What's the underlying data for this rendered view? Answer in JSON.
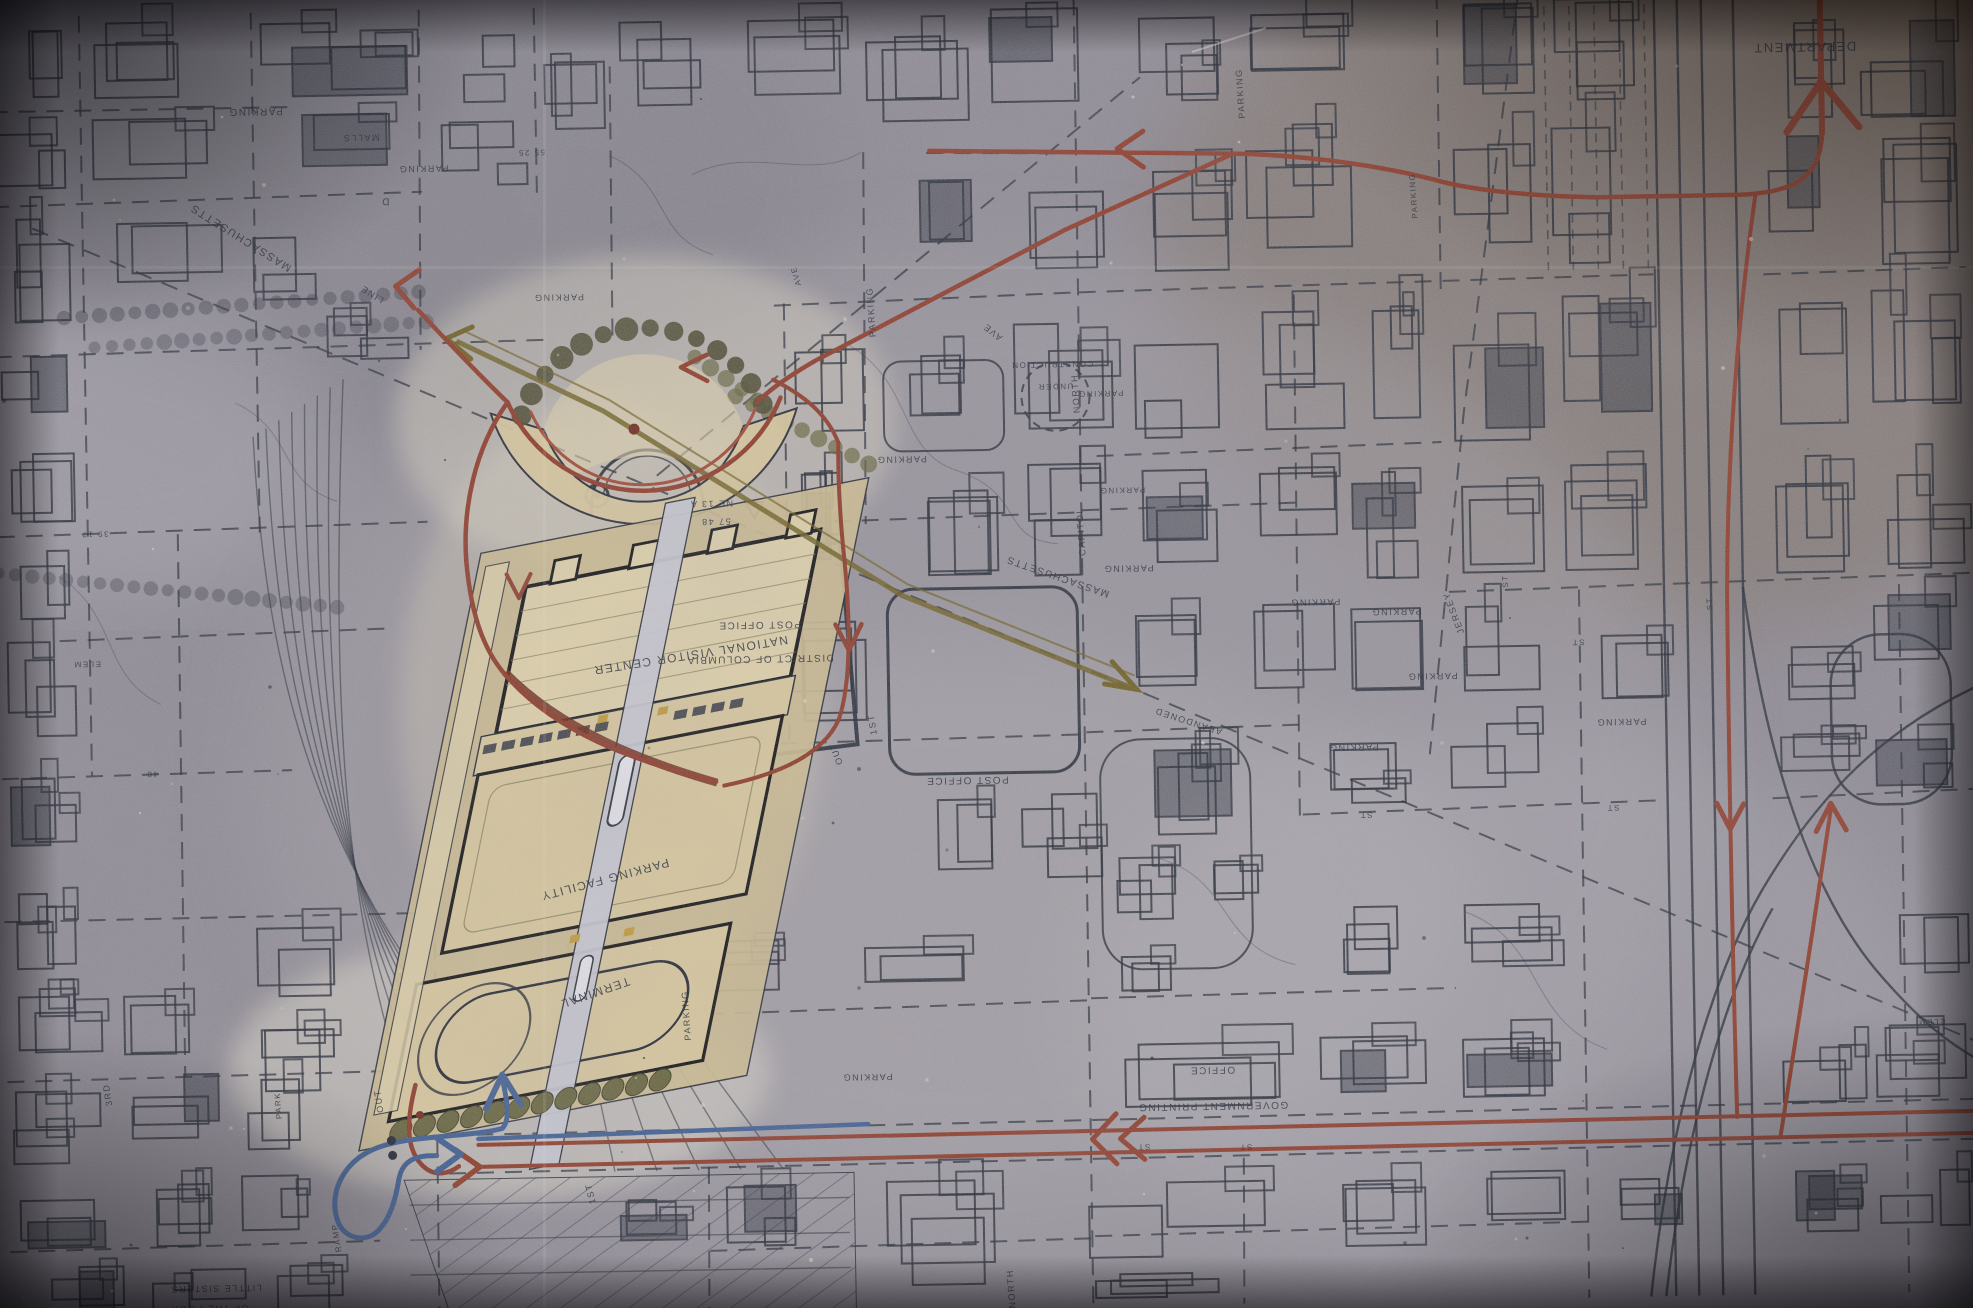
{
  "colors": {
    "paper": "#8f8b96",
    "paper_light": "#a29ea6",
    "paper_brown": "#7a6b58",
    "ink": "#242936",
    "route_red": "#8e3b2a",
    "route_red_bright": "#a24936",
    "route_red_dark": "#6e2a1e",
    "route_blue": "#3f5e93",
    "route_olive": "#6f6023",
    "site_tan": "#d7c79e",
    "site_tan_light": "#ddd0ab",
    "site_tan_deep": "#cbbb92",
    "spine": "#c7c8d4",
    "vehicle_white": "#e4e4eb",
    "vehicle_yellow": "#c09a3a",
    "tree_dark": "#4e4c33",
    "tree_olive": "#67653f"
  },
  "map_labels": [
    {
      "text": "DEPARTMENT",
      "x": 1815,
      "y": 57,
      "r": 180,
      "s": 13,
      "kind": "building"
    },
    {
      "text": "PARKING",
      "x": 265,
      "y": 96,
      "r": 180,
      "s": 10,
      "kind": "area"
    },
    {
      "text": "PARKING",
      "x": 432,
      "y": 156,
      "r": 180,
      "s": 9,
      "kind": "area"
    },
    {
      "text": "MALLS",
      "x": 370,
      "y": 124,
      "r": 180,
      "s": 9,
      "kind": "area"
    },
    {
      "text": "PARKING",
      "x": 565,
      "y": 287,
      "r": 180,
      "s": 9,
      "kind": "area"
    },
    {
      "text": "D",
      "x": 393,
      "y": 188,
      "r": 180,
      "s": 10,
      "kind": "street"
    },
    {
      "text": "MASSACHUSETTS",
      "x": 250,
      "y": 222,
      "r": 213,
      "s": 11,
      "kind": "street"
    },
    {
      "text": "LINE",
      "x": 380,
      "y": 281,
      "r": 213,
      "s": 9,
      "kind": "street"
    },
    {
      "text": "55 25",
      "x": 540,
      "y": 142,
      "r": 180,
      "s": 8,
      "kind": "note"
    },
    {
      "text": "PARKING",
      "x": 1253,
      "y": 98,
      "r": 267,
      "s": 9,
      "kind": "area"
    },
    {
      "text": "PARKING",
      "x": 1424,
      "y": 203,
      "r": 267,
      "s": 8,
      "kind": "area"
    },
    {
      "text": "PARKING",
      "x": 880,
      "y": 310,
      "r": 267,
      "s": 9,
      "kind": "area"
    },
    {
      "text": "AVE",
      "x": 1000,
      "y": 330,
      "r": 220,
      "s": 9,
      "kind": "street"
    },
    {
      "text": "AVE",
      "x": 805,
      "y": 272,
      "r": 255,
      "s": 8,
      "kind": "street"
    },
    {
      "text": "NORTH",
      "x": 1083,
      "y": 395,
      "r": 267,
      "s": 9,
      "kind": "street"
    },
    {
      "text": "CAPITOL",
      "x": 1086,
      "y": 533,
      "r": 267,
      "s": 9,
      "kind": "street"
    },
    {
      "text": "PARKING",
      "x": 905,
      "y": 455,
      "r": 180,
      "s": 9,
      "kind": "area"
    },
    {
      "text": "PARKING",
      "x": 1105,
      "y": 393,
      "r": 180,
      "s": 8,
      "kind": "area"
    },
    {
      "text": "CONSTRUCTION",
      "x": 1057,
      "y": 363,
      "r": 180,
      "s": 8,
      "kind": "note"
    },
    {
      "text": "UNDER",
      "x": 1060,
      "y": 385,
      "r": 180,
      "s": 8,
      "kind": "note"
    },
    {
      "text": "PARKING",
      "x": 1125,
      "y": 490,
      "r": 180,
      "s": 8,
      "kind": "area"
    },
    {
      "text": "PARKING",
      "x": 1130,
      "y": 568,
      "r": 180,
      "s": 9,
      "kind": "area"
    },
    {
      "text": "NE 13 A",
      "x": 714,
      "y": 496,
      "r": 180,
      "s": 9,
      "kind": "note"
    },
    {
      "text": "57 48",
      "x": 718,
      "y": 514,
      "r": 180,
      "s": 9,
      "kind": "note"
    },
    {
      "text": "NATIONAL VISITOR CENTER",
      "x": 690,
      "y": 646,
      "r": 172,
      "s": 12,
      "kind": "building"
    },
    {
      "text": "PARKING FACILITY",
      "x": 600,
      "y": 869,
      "r": 166,
      "s": 12,
      "kind": "building"
    },
    {
      "text": "TERMINAL",
      "x": 588,
      "y": 982,
      "r": 162,
      "s": 12,
      "kind": "building"
    },
    {
      "text": "OUT",
      "x": 837,
      "y": 750,
      "r": 250,
      "s": 9,
      "kind": "note"
    },
    {
      "text": "OUT",
      "x": 374,
      "y": 1090,
      "r": 262,
      "s": 9,
      "kind": "note"
    },
    {
      "text": "RAMP",
      "x": 329,
      "y": 1226,
      "r": 262,
      "s": 8,
      "kind": "note"
    },
    {
      "text": "1ST",
      "x": 874,
      "y": 722,
      "r": 262,
      "s": 9,
      "kind": "street"
    },
    {
      "text": "1ST",
      "x": 584,
      "y": 1186,
      "r": 258,
      "s": 9,
      "kind": "street"
    },
    {
      "text": "POST OFFICE",
      "x": 760,
      "y": 618,
      "r": 180,
      "s": 10,
      "kind": "building"
    },
    {
      "text": "DISTRICT OF COLUMBIA",
      "x": 760,
      "y": 652,
      "r": 180,
      "s": 10,
      "kind": "building"
    },
    {
      "text": "POST OFFICE",
      "x": 965,
      "y": 777,
      "r": 180,
      "s": 10,
      "kind": "building"
    },
    {
      "text": "MASSACHUSETTS",
      "x": 1060,
      "y": 575,
      "r": 200,
      "s": 10,
      "kind": "street"
    },
    {
      "text": "ABANDONED",
      "x": 1188,
      "y": 722,
      "r": 199,
      "s": 9,
      "kind": "note"
    },
    {
      "text": "PARKING",
      "x": 1316,
      "y": 605,
      "r": 180,
      "s": 9,
      "kind": "area"
    },
    {
      "text": "PARKING",
      "x": 1397,
      "y": 616,
      "r": 180,
      "s": 9,
      "kind": "area"
    },
    {
      "text": "PARKING",
      "x": 1432,
      "y": 681,
      "r": 180,
      "s": 9,
      "kind": "area"
    },
    {
      "text": "PARKING",
      "x": 1620,
      "y": 730,
      "r": 180,
      "s": 9,
      "kind": "area"
    },
    {
      "text": "PARKING",
      "x": 1352,
      "y": 751,
      "r": 180,
      "s": 9,
      "kind": "area"
    },
    {
      "text": "JERSEY",
      "x": 1457,
      "y": 620,
      "r": 250,
      "s": 9,
      "kind": "street"
    },
    {
      "text": "ST",
      "x": 1509,
      "y": 590,
      "r": 267,
      "s": 8,
      "kind": "street"
    },
    {
      "text": "ST",
      "x": 1578,
      "y": 650,
      "r": 180,
      "s": 8,
      "kind": "street"
    },
    {
      "text": "ST",
      "x": 1610,
      "y": 816,
      "r": 180,
      "s": 8,
      "kind": "street"
    },
    {
      "text": "ST",
      "x": 1363,
      "y": 819,
      "r": 180,
      "s": 8,
      "kind": "street"
    },
    {
      "text": "ST",
      "x": 1713,
      "y": 616,
      "r": 267,
      "s": 8,
      "kind": "street"
    },
    {
      "text": "ST",
      "x": 1135,
      "y": 1147,
      "r": 180,
      "s": 8,
      "kind": "street"
    },
    {
      "text": "ST",
      "x": 1237,
      "y": 1149,
      "r": 180,
      "s": 8,
      "kind": "street"
    },
    {
      "text": "GOVERNMENT PRINTING",
      "x": 1205,
      "y": 1107,
      "r": 180,
      "s": 10,
      "kind": "building"
    },
    {
      "text": "OFFICE",
      "x": 1205,
      "y": 1071,
      "r": 180,
      "s": 10,
      "kind": "building"
    },
    {
      "text": "PARKING",
      "x": 860,
      "y": 1072,
      "r": 180,
      "s": 9,
      "kind": "area"
    },
    {
      "text": "PARKING",
      "x": 683,
      "y": 1010,
      "r": 267,
      "s": 9,
      "kind": "area"
    },
    {
      "text": "NORTH",
      "x": 1003,
      "y": 1289,
      "r": 267,
      "s": 9,
      "kind": "street"
    },
    {
      "text": "3RD",
      "x": 103,
      "y": 1079,
      "r": 262,
      "s": 9,
      "kind": "street"
    },
    {
      "text": "PARK",
      "x": 273,
      "y": 1093,
      "r": 267,
      "s": 8,
      "kind": "area"
    },
    {
      "text": "LITTLE SISTERS",
      "x": 205,
      "y": 1272,
      "r": 180,
      "s": 9,
      "kind": "building"
    },
    {
      "text": "OF THE POOR",
      "x": 198,
      "y": 1292,
      "r": 180,
      "s": 9,
      "kind": "building"
    },
    {
      "text": "ELEM",
      "x": 87,
      "y": 646,
      "r": 180,
      "s": 8,
      "kind": "building"
    },
    {
      "text": "ELEM",
      "x": 1925,
      "y": 1036,
      "r": 180,
      "s": 8,
      "kind": "building"
    },
    {
      "text": "39 17",
      "x": 97,
      "y": 516,
      "r": 180,
      "s": 8,
      "kind": "note"
    },
    {
      "text": "48",
      "x": 150,
      "y": 757,
      "r": 180,
      "s": 8,
      "kind": "note"
    }
  ]
}
